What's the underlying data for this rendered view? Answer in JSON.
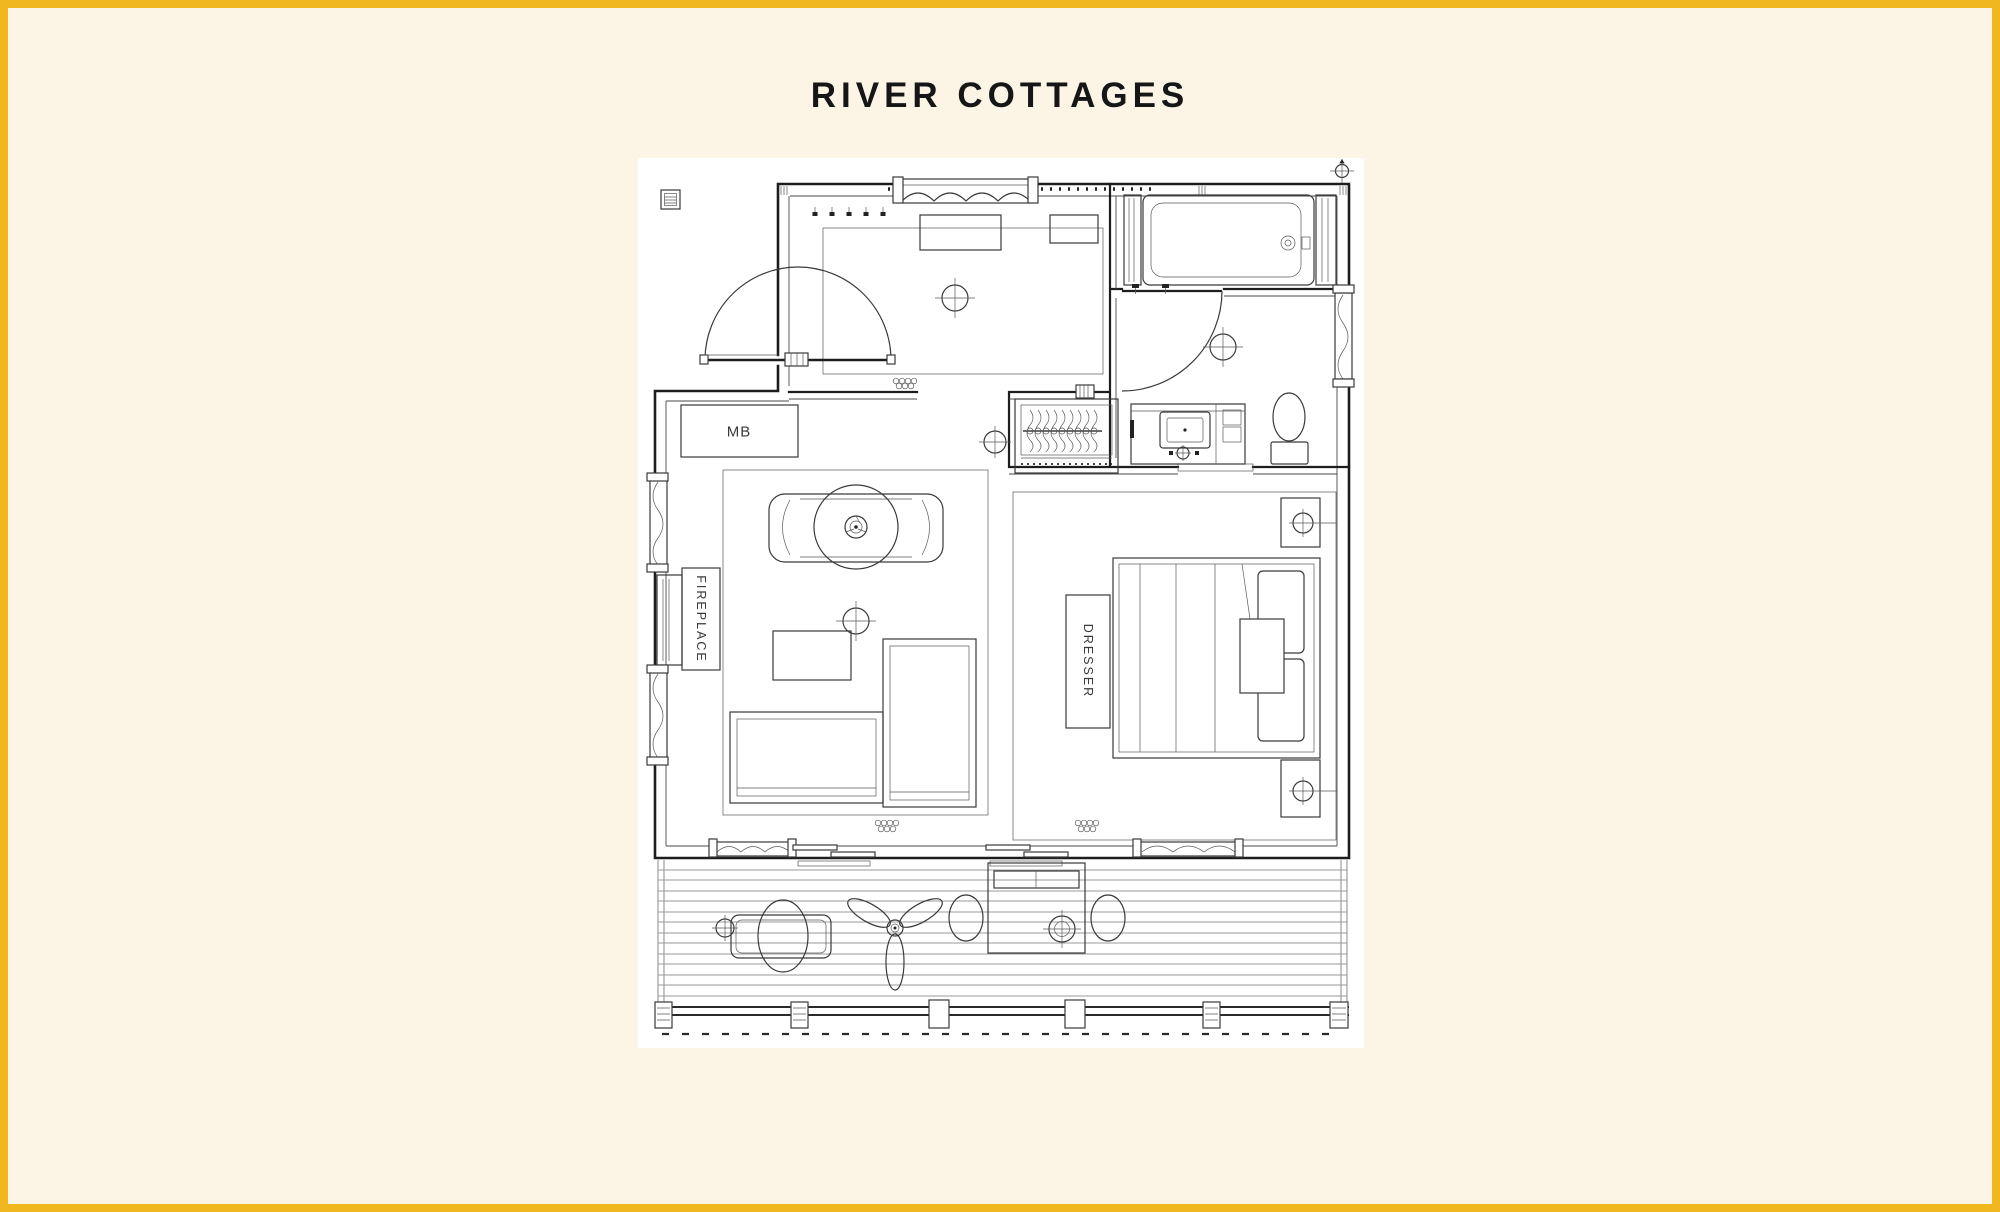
{
  "title": "RIVER COTTAGES",
  "plan": {
    "labels": {
      "master_bedroom": "MB",
      "fireplace": "FIREPLACE",
      "dresser": "DRESSER"
    }
  },
  "colors": {
    "frame": "#F0B71E",
    "background": "#FCF5E6",
    "sheet": "#FFFFFF",
    "walls": "#1D1D1D",
    "furniture": "#3A3A3A",
    "deck_boards": "#9A9A9A"
  }
}
